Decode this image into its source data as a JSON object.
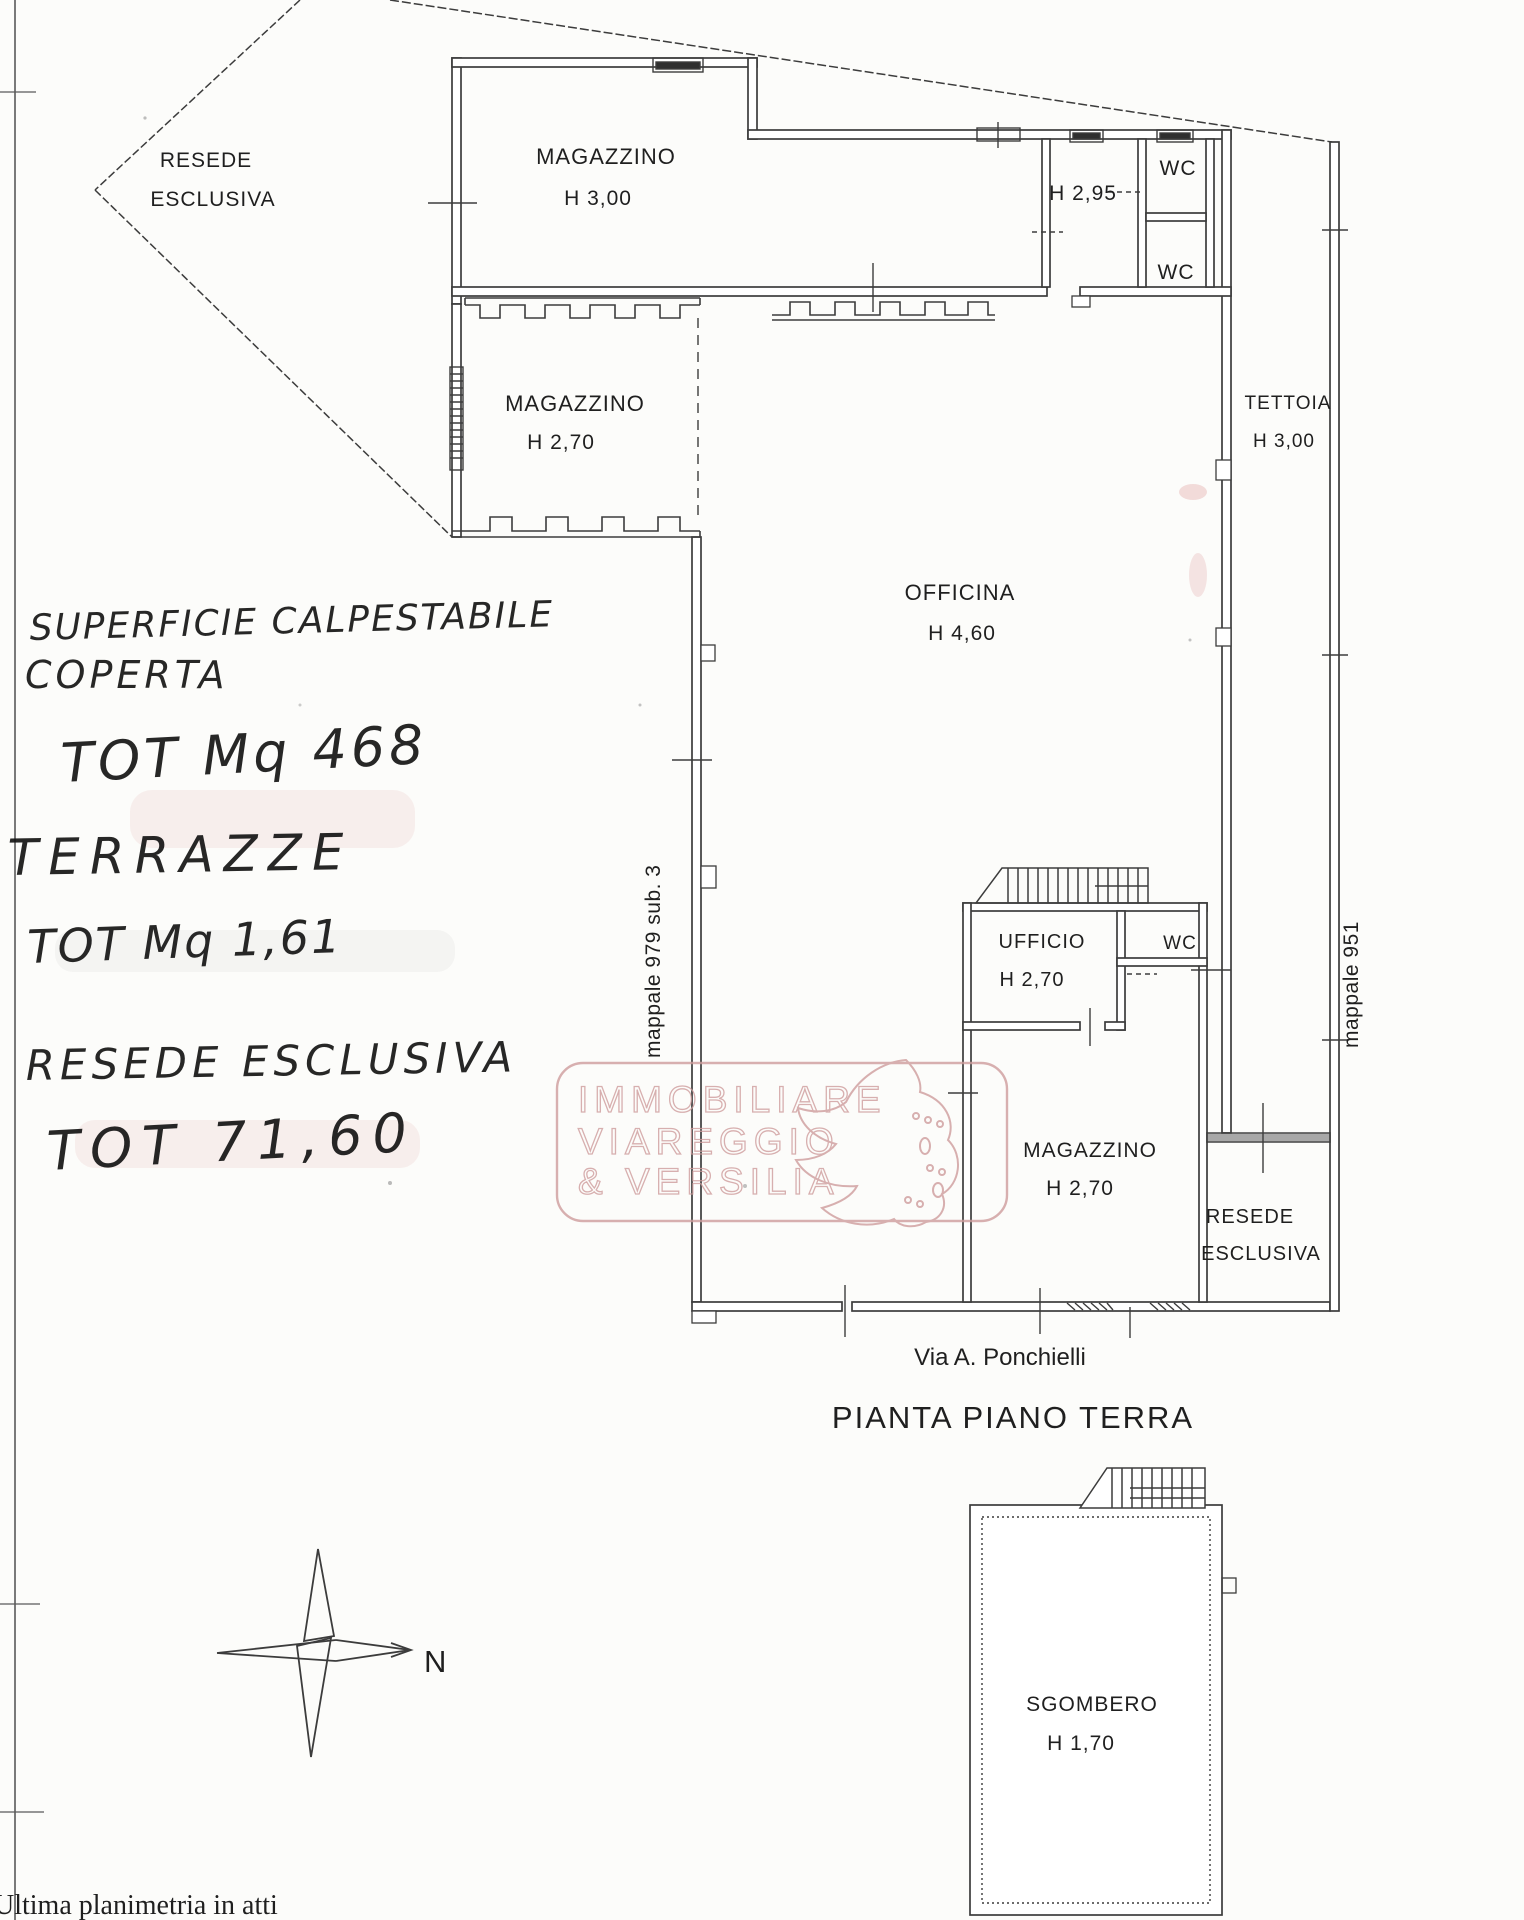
{
  "page": {
    "title": "PIANTA PIANO TERRA",
    "street": "Via A. Ponchielli",
    "footer": "Ultima planimetria in atti",
    "compass_north": "N"
  },
  "parcels": {
    "left": "mappale 979 sub. 3",
    "right": "mappale 951"
  },
  "watermark": {
    "line1": "IMMOBILIARE",
    "line2": "VIAREGGIO",
    "line3": "& VERSILIA"
  },
  "rooms": {
    "resede_nw": {
      "line1": "RESEDE",
      "line2": "ESCLUSIVA"
    },
    "magazzino_top": {
      "label": "MAGAZZINO",
      "height": "H 3,00"
    },
    "vano_h295": {
      "height": "H 2,95"
    },
    "wc_top": {
      "label": "WC"
    },
    "wc_bottom": {
      "label": "WC"
    },
    "tettoia": {
      "label": "TETTOIA",
      "height": "H 3,00"
    },
    "magazzino_west": {
      "label": "MAGAZZINO",
      "height": "H 2,70"
    },
    "officina": {
      "label": "OFFICINA",
      "height": "H 4,60"
    },
    "ufficio": {
      "label": "UFFICIO",
      "height": "H 2,70"
    },
    "wc_ufficio": {
      "label": "WC"
    },
    "magazzino_south": {
      "label": "MAGAZZINO",
      "height": "H 2,70"
    },
    "resede_se": {
      "line1": "RESEDE",
      "line2": "ESCLUSIVA"
    },
    "sgombero": {
      "label": "SGOMBERO",
      "height": "H 1,70"
    }
  },
  "handwriting": {
    "line1": "SUPERFICIE CALPESTABILE",
    "line2": "COPERTA",
    "line3": "TOT Mq 468",
    "line4": "TERRAZZE",
    "line5": "TOT Mq 1,61",
    "line6": "RESEDE ESCLUSIVA",
    "line7": "TOT 71,60"
  },
  "colors": {
    "ink": "#1f1f1f",
    "line": "#3c3c3c",
    "hand": "#151515",
    "watermark_pink": "#cf9d9d"
  }
}
